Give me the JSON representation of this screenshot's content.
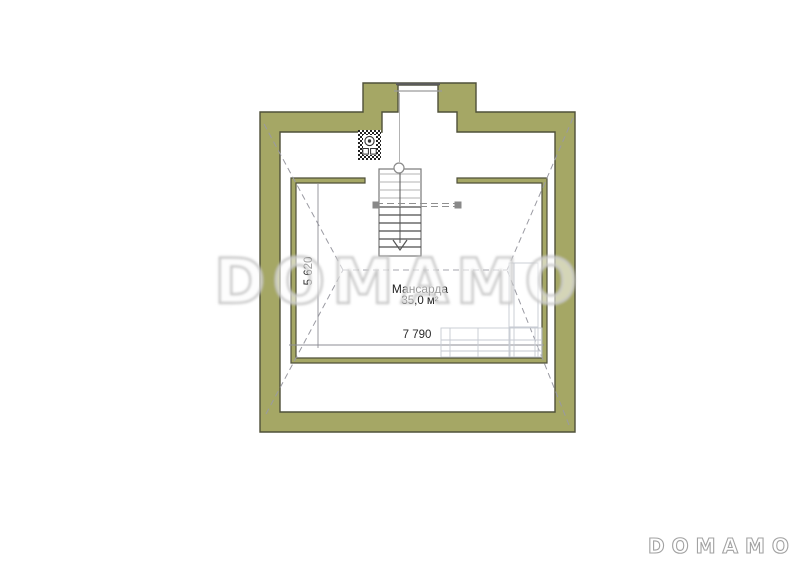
{
  "watermark": {
    "text": "DOMAMO"
  },
  "brand": {
    "text": "DOMAMO"
  },
  "plan": {
    "room": {
      "name": "Мансарда",
      "area": "35,0 м²"
    },
    "dimensions": {
      "width": "7 790",
      "depth": "5 620"
    },
    "colors": {
      "wall_fill": "#a5a765",
      "wall_outline": "#4f5039",
      "roof_dash_line": "#9a9aa2",
      "dimension_line": "#8d8d95",
      "furniture_line": "#c6cad2",
      "stair_tread_dark": "#4d4d4d",
      "stair_tread_light": "#b3b3b3",
      "watermark_gray": "#c5c5c5"
    }
  }
}
